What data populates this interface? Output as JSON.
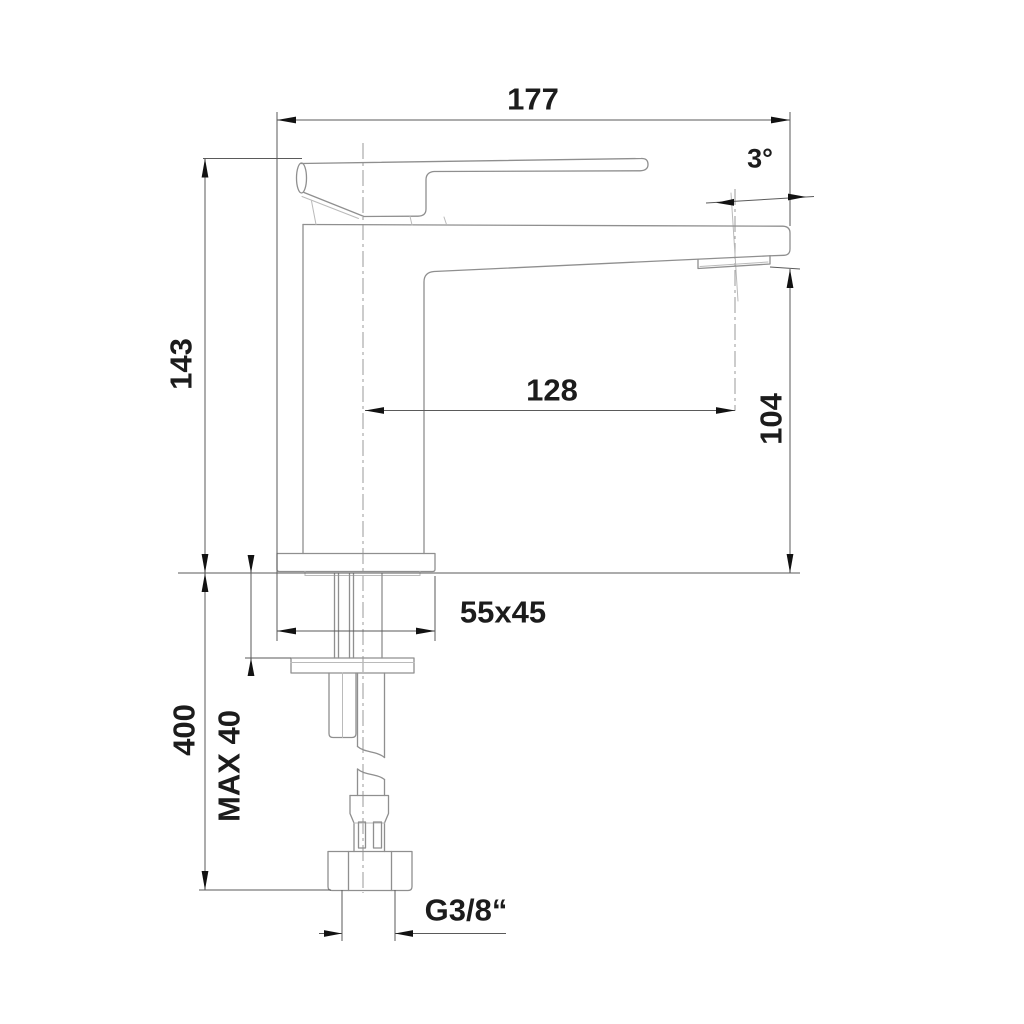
{
  "drawing": {
    "kind": "technical-dimension-drawing",
    "subject": "single-lever basin mixer faucet, side elevation with installation dimensions"
  },
  "labels": {
    "overall_length": "177",
    "spout_angle": "3°",
    "height_above_deck": "143",
    "spout_reach": "128",
    "outlet_height": "104",
    "base_size": "55x45",
    "max_deck_thickness": "MAX 40",
    "below_deck_length": "400",
    "thread_size": "G3/8“"
  },
  "colors": {
    "background": "#ffffff",
    "faucet_outline": "#8f8f8f",
    "light_seam": "#bababa",
    "dimension_line": "#5a5a5a",
    "centerline": "#9a9a9a",
    "arrow": "#121212",
    "text": "#1c1c1c"
  }
}
